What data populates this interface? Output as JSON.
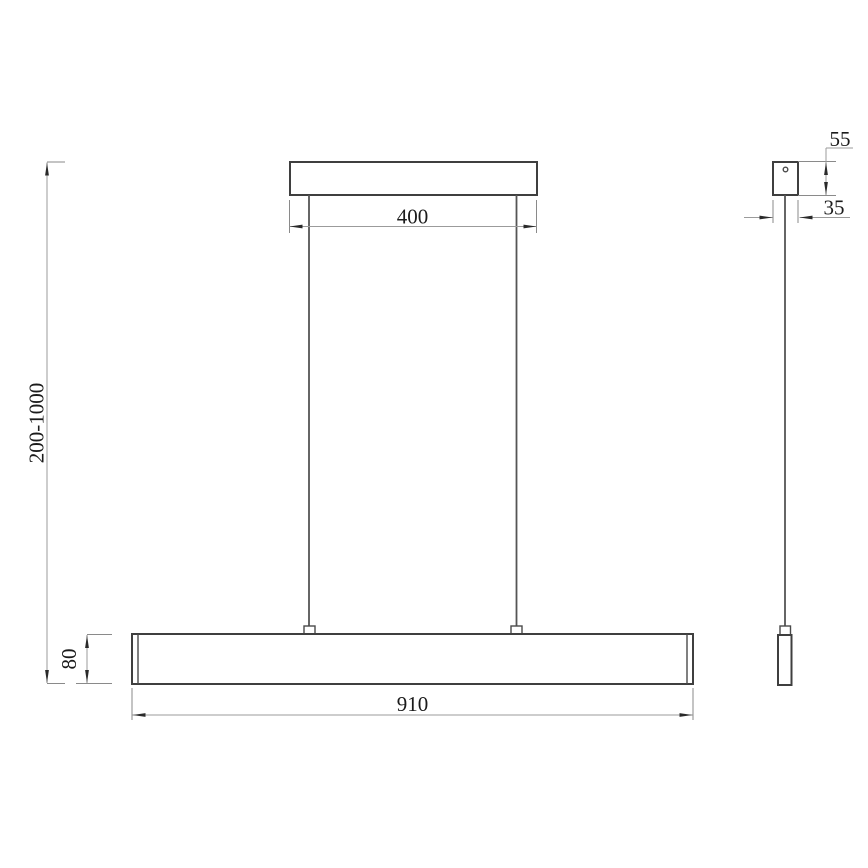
{
  "drawing": {
    "background": "#ffffff",
    "object_line_color": "#3f3f3f",
    "dimension_line_color": "#9b9b9b",
    "text_color": "#1b1b1b",
    "dimensions": {
      "canopy_width": "400",
      "suspension_height": "200-1000",
      "bar_height": "80",
      "bar_length": "910",
      "side_canopy_height": "55",
      "side_canopy_width": "35"
    }
  }
}
